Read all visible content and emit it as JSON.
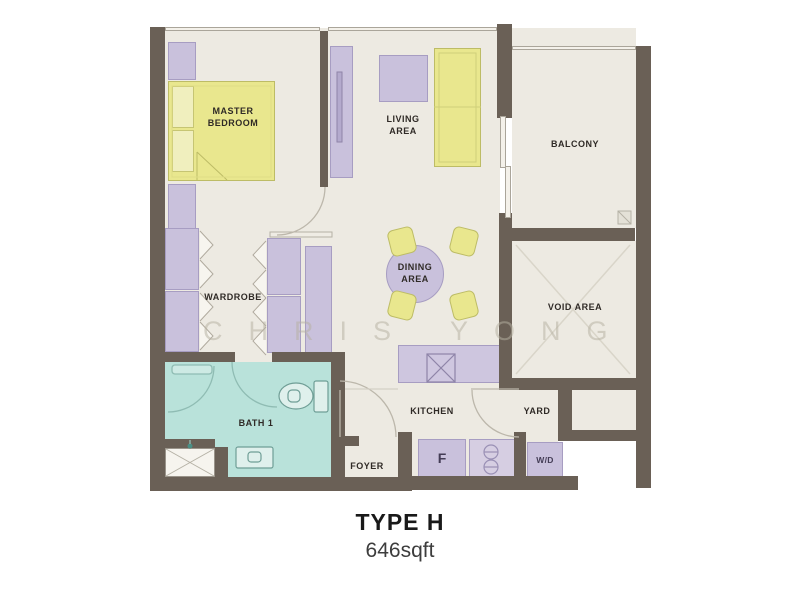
{
  "plan": {
    "title": "TYPE H",
    "area": "646sqft",
    "watermark": "CHRIS YONG",
    "rooms": {
      "master_bedroom": "MASTER BEDROOM",
      "living_area": "LIVING AREA",
      "balcony": "BALCONY",
      "wardrobe": "WARDROBE",
      "dining_area": "DINING AREA",
      "void_area": "VOID AREA",
      "bath1": "BATH 1",
      "foyer": "FOYER",
      "kitchen": "KITCHEN",
      "yard": "YARD"
    },
    "appliances": {
      "fridge": "F",
      "washer_dryer": "W/D"
    },
    "colors": {
      "wall": "#6a6056",
      "floor": "#edeae2",
      "bath": "#b9e2da",
      "furniture_purple": "#c9c1dc",
      "furniture_yellow": "#e9e78e",
      "label_text": "#2f2a26"
    }
  }
}
